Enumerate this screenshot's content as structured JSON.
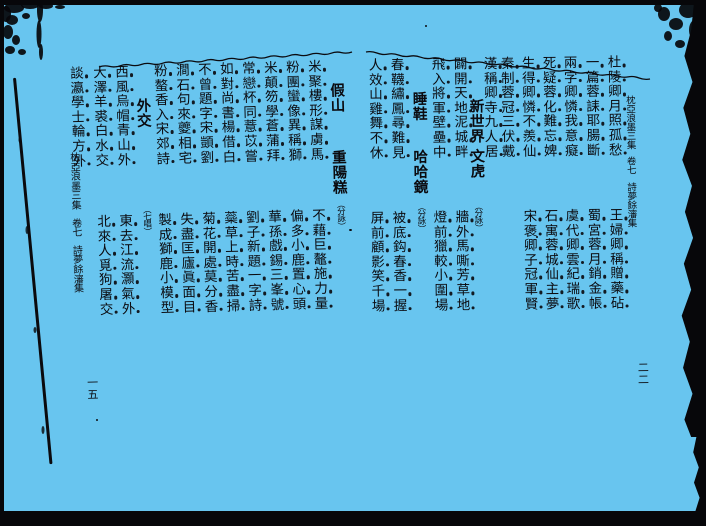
{
  "palette": {
    "background": "#68c5ef",
    "ink": "#0b0b10"
  },
  "right_page": {
    "header": {
      "book_title": "枕亞浪墨三集",
      "volume": "卷七",
      "collection": "詩夢餘瀋集"
    },
    "page_number": "二二",
    "columns": [
      {
        "type": "verse",
        "top": "杜陵卿月照孤愁",
        "bottom": "王婦卿稱贈藥砧"
      },
      {
        "type": "verse",
        "top": "一篇蓉誄耶腸斷",
        "bottom": "蜀宮蓉月銷金帳"
      },
      {
        "type": "verse",
        "top": "兩字卿憐我意癡",
        "bottom": "虞代卿雲紀瑞歌"
      },
      {
        "type": "verse",
        "top": "死疑蓉化難忘婢",
        "bottom": "石寓蓉城仙主夢"
      },
      {
        "type": "verse",
        "top": "生得卿憐不羨仙",
        "bottom": "宋褒卿子冠軍賢"
      },
      {
        "type": "verse",
        "top": "秦制蓉冠三伏戴",
        "bottom": ""
      },
      {
        "type": "verse",
        "top": "漢稱卿寺九人居",
        "bottom": ""
      },
      {
        "type": "topics",
        "topics": [
          {
            "text": "新世界",
            "dy": 43
          },
          {
            "text": "文虎",
            "dy": 93
          }
        ],
        "note": "分詠"
      },
      {
        "type": "verse",
        "top": "闢開天地泥城畔",
        "bottom": "牆外馬嘶芳草地"
      },
      {
        "type": "verse",
        "top": "飛入將軍壁壘中",
        "bottom": "燈前獵較小圍場"
      },
      {
        "type": "topics",
        "topics": [
          {
            "text": "睡鞋",
            "dy": 35
          },
          {
            "text": "哈哈鏡",
            "dy": 93
          }
        ],
        "note": "分詠"
      },
      {
        "type": "verse",
        "top": "春韈繡鳳尋難見",
        "bottom": "被底鈎春香一握"
      },
      {
        "type": "verse",
        "top": "人效山雞舞不休",
        "bottom": "屏前顧影笑千場"
      }
    ]
  },
  "left_page": {
    "header": {
      "book_title": "枕亞浪墨三集",
      "volume": "卷七",
      "collection": "詩夢餘瀋集"
    },
    "page_number": "一五",
    "columns": [
      {
        "type": "topics",
        "topics": [
          {
            "text": "假山",
            "dy": 25
          },
          {
            "text": "重陽糕",
            "dy": 92
          }
        ],
        "note": "分詠"
      },
      {
        "type": "verse",
        "top": "米聚樓形謀虜馬",
        "bottom": "不藉巨鼇施力量"
      },
      {
        "type": "verse",
        "top": "粉團蠻像異稱獅",
        "bottom": "偏多小鹿置心頭"
      },
      {
        "type": "verse",
        "top": "米顛笏學蒼蒲拜",
        "bottom": "華孫戲錫三峯號"
      },
      {
        "type": "verse",
        "top": "常戀杯同薏苡嘗",
        "bottom": "劉子新題一字詩"
      },
      {
        "type": "verse",
        "top": "如對尚書楊借白",
        "bottom": "蘂草上時苦盡掃"
      },
      {
        "type": "verse",
        "top": "不曾題字宋顗劉",
        "bottom": "菊花開處莫分香"
      },
      {
        "type": "verse",
        "top": "澗石句來夔相宅",
        "bottom": "失盡匡廬眞面目"
      },
      {
        "type": "verse",
        "top": "粉螯香入宋郊詩",
        "bottom": "製成獅鹿小模型"
      },
      {
        "type": "topics",
        "topics": [
          {
            "text": "外交",
            "dy": 35
          }
        ],
        "note": "七唱"
      },
      {
        "type": "verse",
        "top": "西風烏帽青山外",
        "bottom": "東去江流灝氣外"
      },
      {
        "type": "verse",
        "top": "大澤羊裘白水交",
        "bottom": "北來人覓狗屠交"
      },
      {
        "type": "verse",
        "top": "談瀛學士輪方外",
        "bottom": ""
      }
    ]
  }
}
